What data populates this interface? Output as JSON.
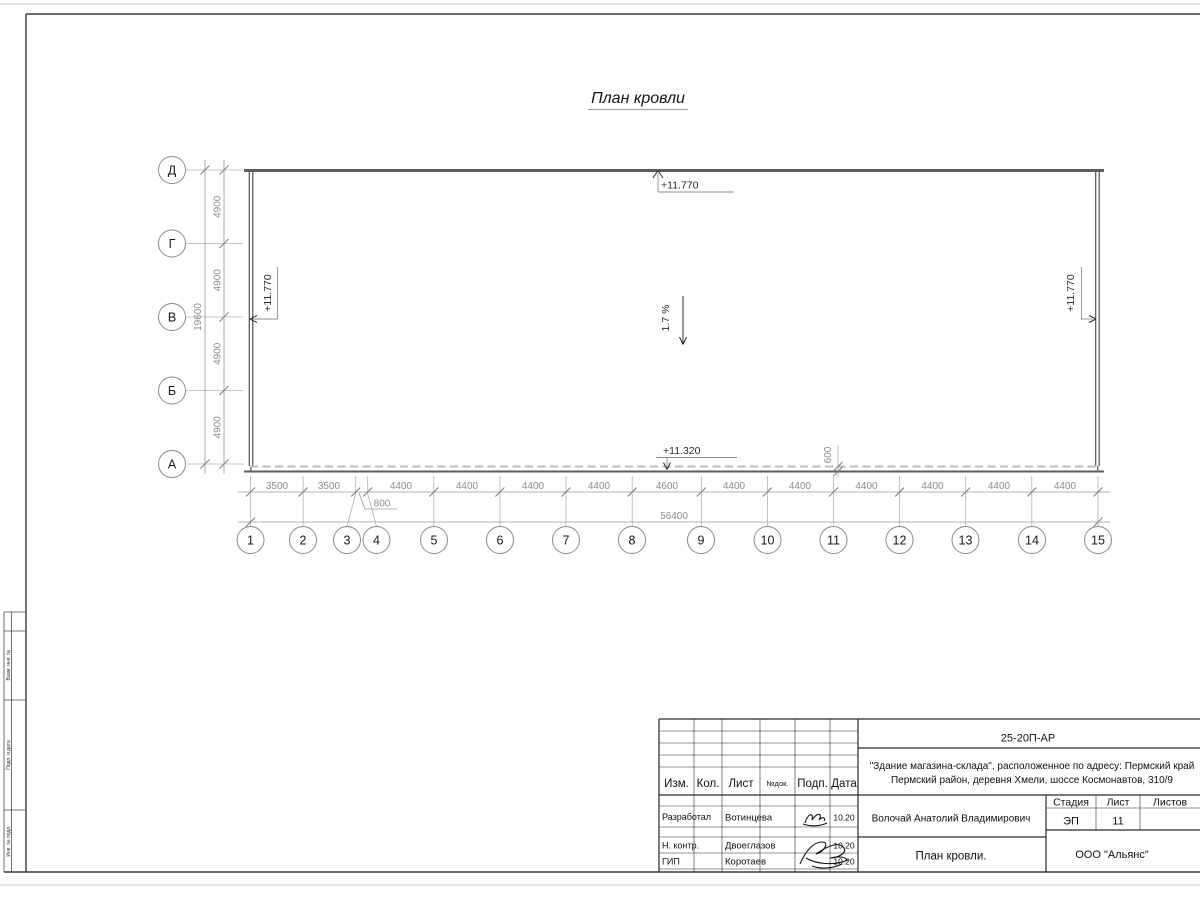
{
  "drawing": {
    "title": "План кровли",
    "row_axes": [
      "Д",
      "Г",
      "В",
      "Б",
      "А"
    ],
    "col_axes": [
      "1",
      "2",
      "3",
      "4",
      "5",
      "6",
      "7",
      "8",
      "9",
      "10",
      "11",
      "12",
      "13",
      "14",
      "15"
    ],
    "row_spans": [
      "4900",
      "4900",
      "4900",
      "4900"
    ],
    "row_total": "19600",
    "col_spans": [
      "3500",
      "3500",
      "800",
      "4400",
      "4400",
      "4400",
      "4400",
      "4600",
      "4400",
      "4400",
      "4400",
      "4400",
      "4400",
      "4400"
    ],
    "col_total": "56400",
    "elev_ridge": "+11.770",
    "elev_left": "+11.770",
    "elev_right": "+11.770",
    "elev_eave": "+11.320",
    "slope": "1.7 %",
    "overhang": "600"
  },
  "margin_labels": [
    "Взам. инв. №",
    "Подп. и дата",
    "Инв. № подл."
  ],
  "titleblock": {
    "code": "25-20П-АР",
    "address1": "\"Здание магазина-склада\", расположенное по адресу: Пермский край",
    "address2": "Пермский район, деревня Хмели, шоссе Космонавтов, 310/9",
    "cols": {
      "izm": "Изм.",
      "kol": "Кол.",
      "list": "Лист",
      "doc": "№док.",
      "sign": "Подп.",
      "date": "Дата"
    },
    "people": [
      {
        "role": "Разработал",
        "name": "Вотинцева",
        "date": "10.20"
      },
      {
        "role": "Н. контр.",
        "name": "Двоеглазов",
        "date": "10.20"
      },
      {
        "role": "ГИП",
        "name": "Коротаев",
        "date": "10.20"
      }
    ],
    "client": "Волочай Анатолий Владимирович",
    "drawing_name": "План кровли.",
    "stage_label": "Стадия",
    "sheet_label": "Лист",
    "sheets_label": "Листов",
    "stage": "ЭП",
    "sheet_no": "11",
    "company": "ООО \"Альянс\""
  }
}
